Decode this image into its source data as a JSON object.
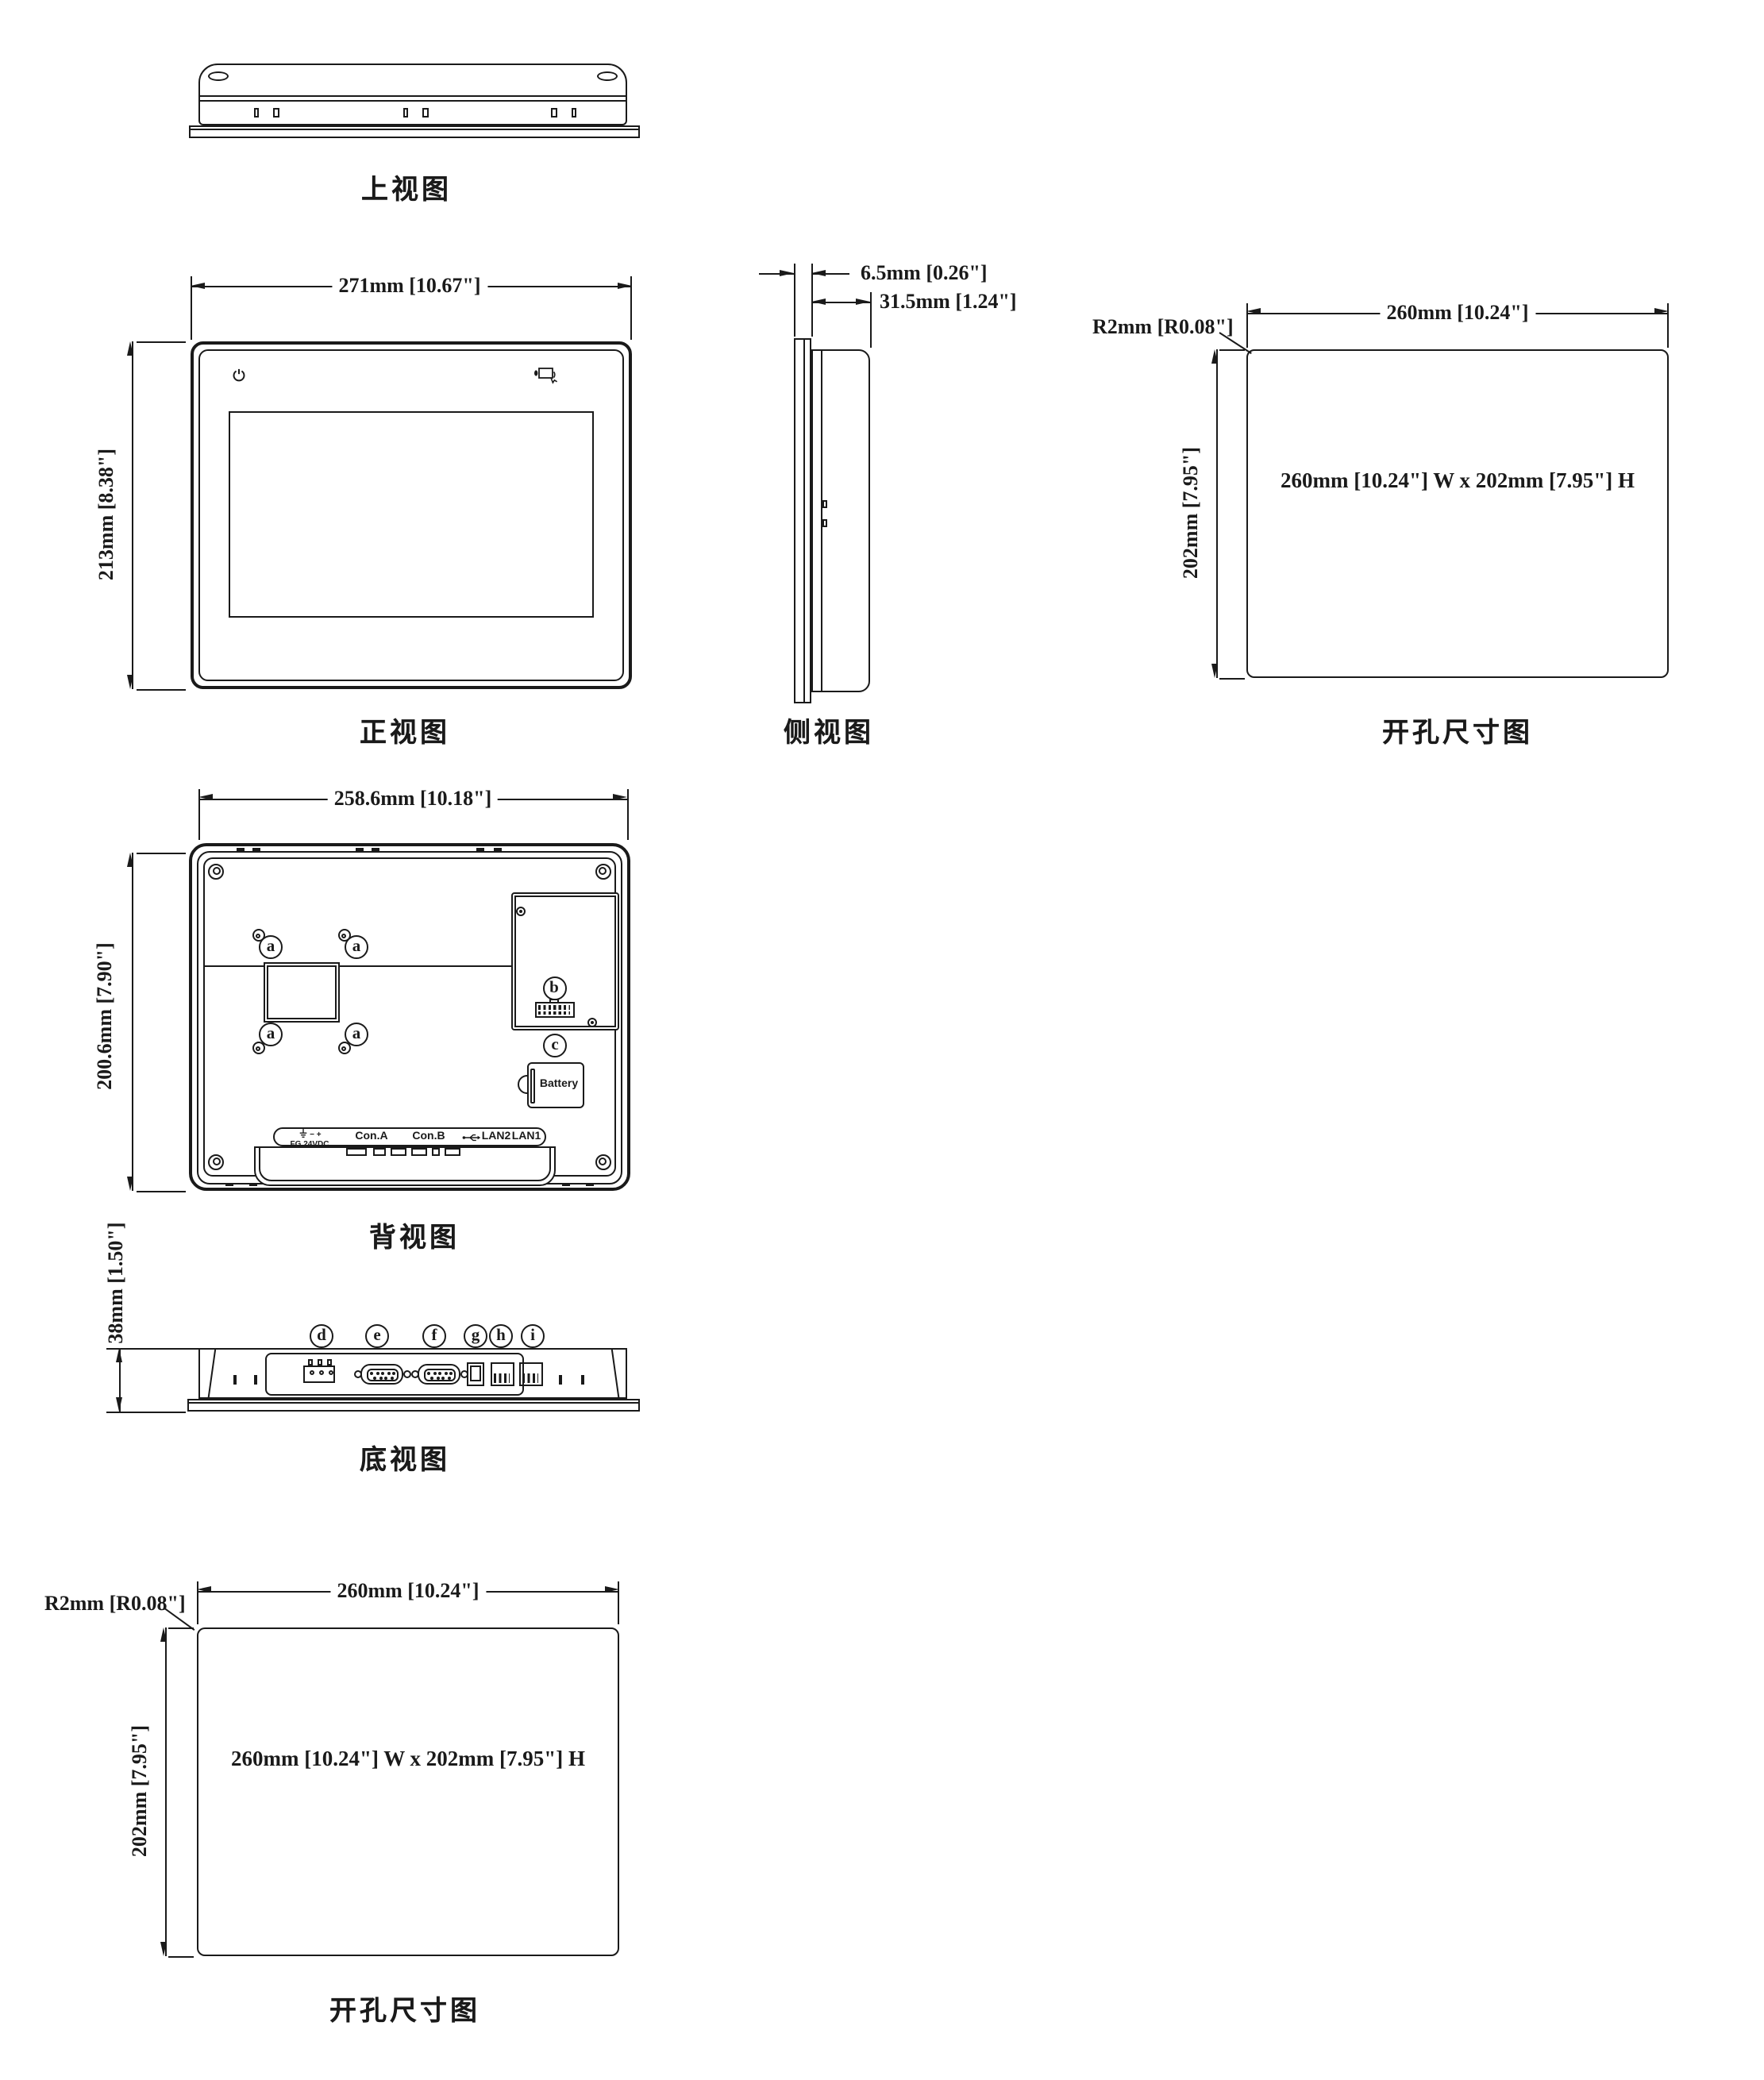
{
  "views": {
    "top": {
      "label": "上视图"
    },
    "front": {
      "label": "正视图",
      "width_dim": "271mm [10.67\"]",
      "height_dim": "213mm [8.38\"]"
    },
    "side": {
      "label": "侧视图",
      "thickness_dim": "6.5mm [0.26\"]",
      "depth_dim": "31.5mm [1.24\"]"
    },
    "cutout_right": {
      "label": "开孔尺寸图",
      "width_dim": "260mm [10.24\"]",
      "height_dim": "202mm [7.95\"]",
      "corner_radius_dim": "R2mm [R0.08\"]",
      "size_note": "260mm [10.24\"] W x 202mm [7.95\"] H"
    },
    "back": {
      "label": "背视图",
      "width_dim": "258.6mm [10.18\"]",
      "height_dim": "200.6mm [7.90\"]",
      "battery_label": "Battery",
      "callouts": {
        "a": "a",
        "b": "b",
        "c": "c"
      },
      "port_strip": {
        "minus_plus": "−  +",
        "fg": "FG",
        "vdc": "24VDC",
        "con_a": "Con.A",
        "con_b": "Con.B",
        "lan2": "LAN2",
        "lan1": "LAN1"
      }
    },
    "bottom": {
      "label": "底视图",
      "depth_dim": "38mm [1.50\"]",
      "callouts": {
        "d": "d",
        "e": "e",
        "f": "f",
        "g": "g",
        "h": "h",
        "i": "i"
      }
    },
    "cutout_bottom": {
      "label": "开孔尺寸图",
      "width_dim": "260mm [10.24\"]",
      "height_dim": "202mm [7.95\"]",
      "corner_radius_dim": "R2mm [R0.08\"]",
      "size_note": "260mm [10.24\"] W x 202mm [7.95\"] H"
    }
  },
  "colors": {
    "line": "#1a1a1a",
    "bg": "#ffffff"
  }
}
